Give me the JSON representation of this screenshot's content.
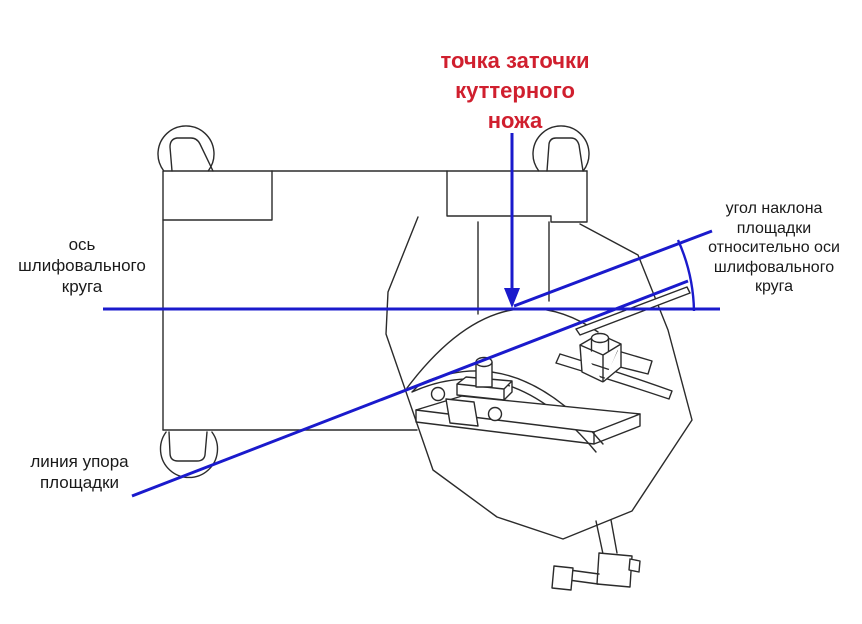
{
  "diagram": {
    "title": "точка заточки\nкуттерного\nножа",
    "labels": {
      "wheel_axis": "ось\nшлифовального\nкруга",
      "platform_angle": "угол наклона\nплощадки\nотносительно оси\nшлифовального\nкруга",
      "support_line": "линия упора\nплощадки"
    },
    "colors": {
      "annotation_blue": "#1a1acc",
      "title_red": "#d01f2e",
      "outline": "#2b2b2b",
      "label_text": "#1a1a1a",
      "background": "#ffffff"
    }
  }
}
